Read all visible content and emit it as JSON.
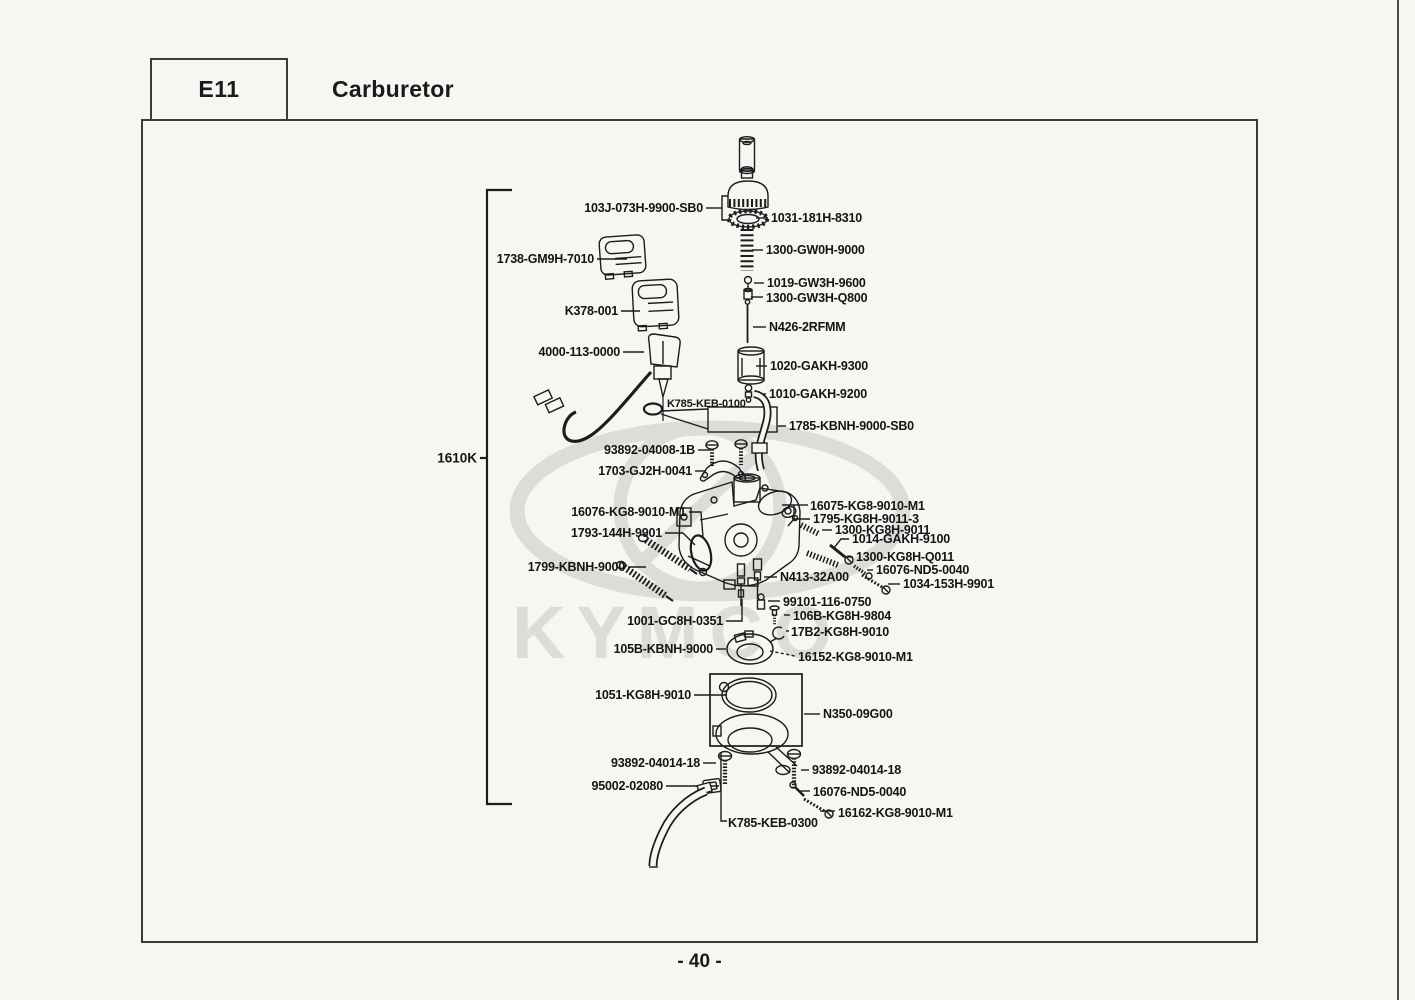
{
  "header": {
    "section_code": "E11",
    "title": "Carburetor"
  },
  "page": {
    "number": "- 40 -"
  },
  "watermark": {
    "brand": "KYMCO"
  },
  "diagram": {
    "group_label": "1610K",
    "parts": [
      {
        "text": "103J-073H-9900-SB0"
      },
      {
        "text": "1031-181H-8310"
      },
      {
        "text": "1300-GW0H-9000"
      },
      {
        "text": "1019-GW3H-9600"
      },
      {
        "text": "1300-GW3H-Q800"
      },
      {
        "text": "N426-2RFMM"
      },
      {
        "text": "1020-GAKH-9300"
      },
      {
        "text": "1010-GAKH-9200"
      },
      {
        "text": "1738-GM9H-7010"
      },
      {
        "text": "K378-001"
      },
      {
        "text": "4000-113-0000"
      },
      {
        "text": "K785-KEB-0100"
      },
      {
        "text": "1785-KBNH-9000-SB0"
      },
      {
        "text": "93892-04008-1B"
      },
      {
        "text": "1703-GJ2H-0041"
      },
      {
        "text": "16076-KG8-9010-M1"
      },
      {
        "text": "16075-KG8-9010-M1"
      },
      {
        "text": "1795-KG8H-9011-3"
      },
      {
        "text": "1300-KG8H-9011"
      },
      {
        "text": "1014-GAKH-9100"
      },
      {
        "text": "1300-KG8H-Q011"
      },
      {
        "text": "16076-ND5-0040"
      },
      {
        "text": "1034-153H-9901"
      },
      {
        "text": "1793-144H-9901"
      },
      {
        "text": "1799-KBNH-9000"
      },
      {
        "text": "N413-32A00"
      },
      {
        "text": "99101-116-0750"
      },
      {
        "text": "1001-GC8H-0351"
      },
      {
        "text": "106B-KG8H-9804"
      },
      {
        "text": "17B2-KG8H-9010"
      },
      {
        "text": "105B-KBNH-9000"
      },
      {
        "text": "16152-KG8-9010-M1"
      },
      {
        "text": "1051-KG8H-9010"
      },
      {
        "text": "N350-09G00"
      },
      {
        "text": "93892-04014-18"
      },
      {
        "text": "93892-04014-18"
      },
      {
        "text": "95002-02080"
      },
      {
        "text": "16076-ND5-0040"
      },
      {
        "text": "16162-KG8-9010-M1"
      },
      {
        "text": "K785-KEB-0300"
      }
    ]
  }
}
